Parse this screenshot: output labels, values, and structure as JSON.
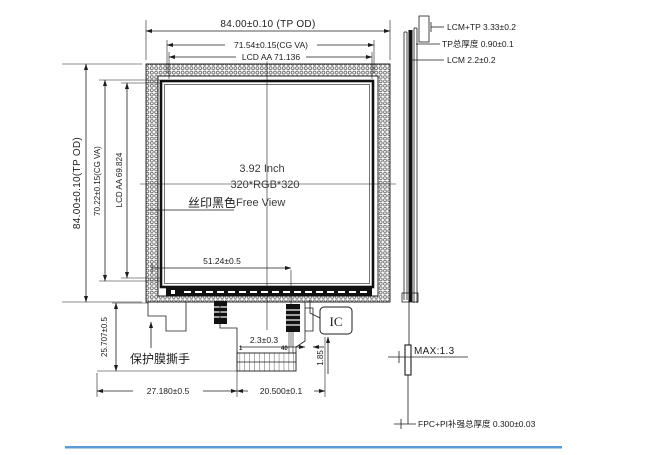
{
  "front": {
    "size_label": "3.92 Inch",
    "resolution_label": "320*RGB*320",
    "silkscreen_label": "丝印黑色",
    "view_label": "Free View",
    "dim_top_od": "84.00±0.10 (TP OD)",
    "dim_top_cg": "71.54±0.15(CG VA)",
    "dim_top_aa": "LCD AA 71.136",
    "dim_left_od": "84.00±0.10(TP OD)",
    "dim_left_cg": "70.22±0.15(CG VA)",
    "dim_left_aa": "LCD AA 69.824",
    "dim_fpc_pos": "51.24±0.5",
    "dim_tab_drop": "25.707±0.5",
    "dim_fpc_left": "27.180±0.5",
    "dim_fpc_width": "20.500±0.1",
    "dim_edge_gap": "2.3±0.3",
    "dim_conn_drop": "1.85",
    "pin_first": "1",
    "pin_last": "40",
    "ic_label": "IC",
    "film_label": "保护膜撕手"
  },
  "side": {
    "lcm_tp": "LCM+TP 3.33±0.2",
    "tp_total": "TP总厚度 0.90±0.1",
    "lcm": "LCM 2.2±0.2",
    "max_label": "MAX:1.3",
    "fpc_pi": "FPC+PI补强总厚度 0.300±0.03"
  },
  "colors": {
    "ink": "#1c1c1c",
    "accent_bar": "#5b9bd5"
  }
}
